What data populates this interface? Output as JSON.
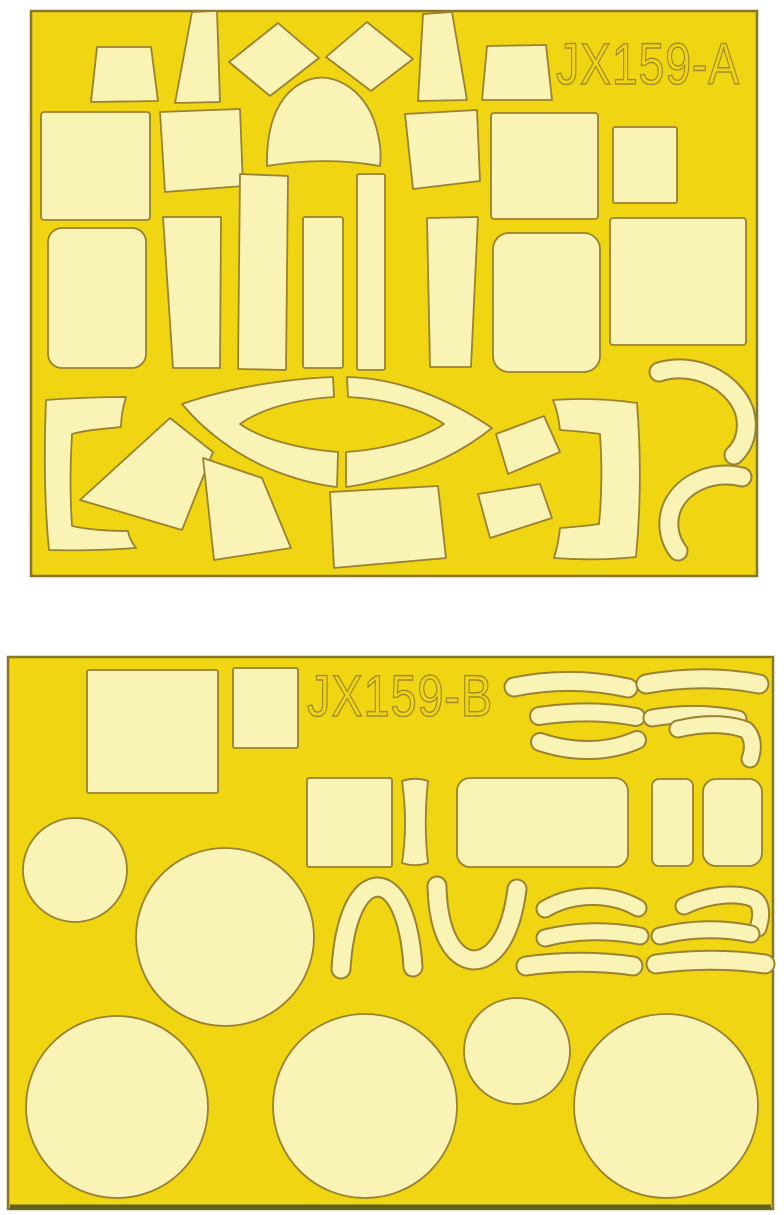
{
  "sheets": [
    {
      "label": "JX159-A",
      "position": "top",
      "pieces_visible": 31
    },
    {
      "label": "JX159-B",
      "position": "bottom",
      "pieces_visible": 27
    }
  ],
  "colors": {
    "page_bg": "#ffffff",
    "sheet_yellow": "#F0D512",
    "mask_cream": "#FAF3B6",
    "cut_outline": "#9A8230",
    "sheet_border": "#8a7425",
    "label_ink": "#9A8230",
    "bottom_edge": "#5f611c"
  }
}
